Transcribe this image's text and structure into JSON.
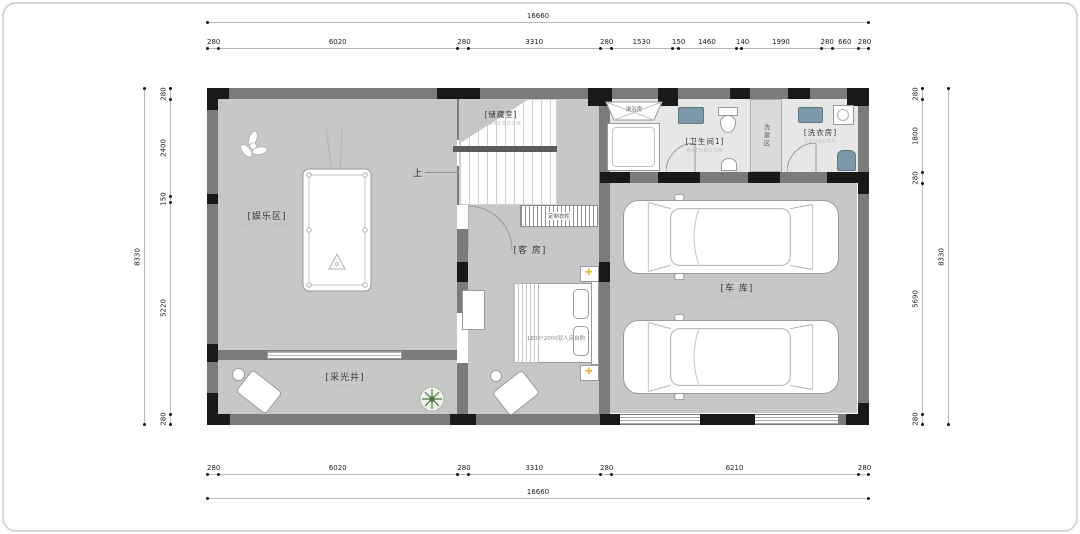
{
  "palette": {
    "wall": "#7b7b7b",
    "column": "#191919",
    "floor": "#c7c7c7",
    "floor_light": "#e7e7e7",
    "fixture_blue": "#7d99a7",
    "lamp_yellow": "#e2b93b",
    "plant_green": "#4c7a3d",
    "dim_text": "#1c1c1c"
  },
  "dimensions": {
    "top_total": "16660",
    "top_segments": [
      "280",
      "6020",
      "280",
      "3310",
      "280",
      "1530",
      "150",
      "1460",
      "140",
      "1990",
      "280",
      "660",
      "280"
    ],
    "bottom_segments": [
      "280",
      "6020",
      "280",
      "3310",
      "280",
      "6210",
      "280"
    ],
    "bottom_total": "16660",
    "left_total": "8330",
    "left_segments": [
      "280",
      "2400",
      "150",
      "5220",
      "280"
    ],
    "right_segments": [
      "280",
      "1800",
      "280",
      "5690",
      "280"
    ],
    "right_total": "8330"
  },
  "rooms": {
    "activity": {
      "cn": "[娱乐区]",
      "en": "ACTIVITY AREA"
    },
    "storage": {
      "cn": "[储藏室]",
      "en": "STOREROOM"
    },
    "guest": {
      "cn": "[客 房]",
      "en": "GUEST ROOM"
    },
    "bathroom1": {
      "cn": "[卫生间1]",
      "en": "BATHROOM"
    },
    "laundry": {
      "cn": "[洗衣房]",
      "en": "LAUNDRY"
    },
    "garage": {
      "cn": "[车 库]",
      "en": "GARAGE"
    },
    "lightwell": {
      "cn": "[采光井]",
      "en": "PORCH"
    }
  },
  "annotations": {
    "up": "上",
    "wardrobe": "定制衣柜",
    "washzone": "洗漱区",
    "shower": "淋浴房",
    "bed": "1800*2000双人床自购"
  }
}
